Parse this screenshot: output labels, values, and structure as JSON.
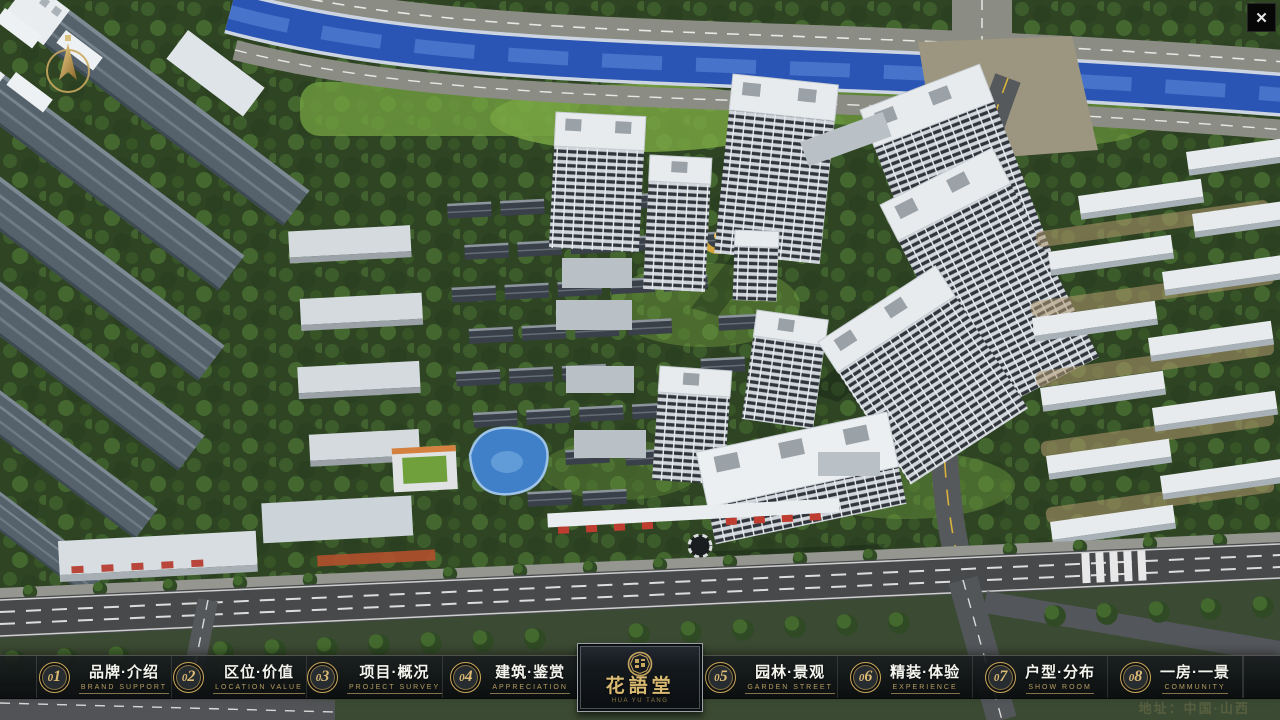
{
  "icons": {
    "close": "✕"
  },
  "navbar": {
    "items": [
      {
        "number": "01",
        "label": "品牌·介绍",
        "sublabel": "BRAND SUPPORT"
      },
      {
        "number": "02",
        "label": "区位·价值",
        "sublabel": "LOCATION VALUE"
      },
      {
        "number": "03",
        "label": "项目·概况",
        "sublabel": "PROJECT SURVEY"
      },
      {
        "number": "04",
        "label": "建筑·鉴赏",
        "sublabel": "APPRECIATION"
      },
      {
        "number": "05",
        "label": "园林·景观",
        "sublabel": "GARDEN STREET"
      },
      {
        "number": "06",
        "label": "精装·体验",
        "sublabel": "EXPERIENCE"
      },
      {
        "number": "07",
        "label": "户型·分布",
        "sublabel": "SHOW ROOM"
      },
      {
        "number": "08",
        "label": "一房·一景",
        "sublabel": "COMMUNITY"
      }
    ]
  },
  "logo": {
    "title": "花語堂",
    "subtitle": "HUA YU TANG"
  },
  "footer": {
    "address": "地址：中国·山西"
  },
  "colors": {
    "accent_gold": "#c8a659",
    "navbar_bg": "#101417",
    "river_blue": "#2a55b4",
    "foliage_green": "#2e4423",
    "road_gray": "#47494b",
    "storefront_red": "#bf3c30"
  }
}
